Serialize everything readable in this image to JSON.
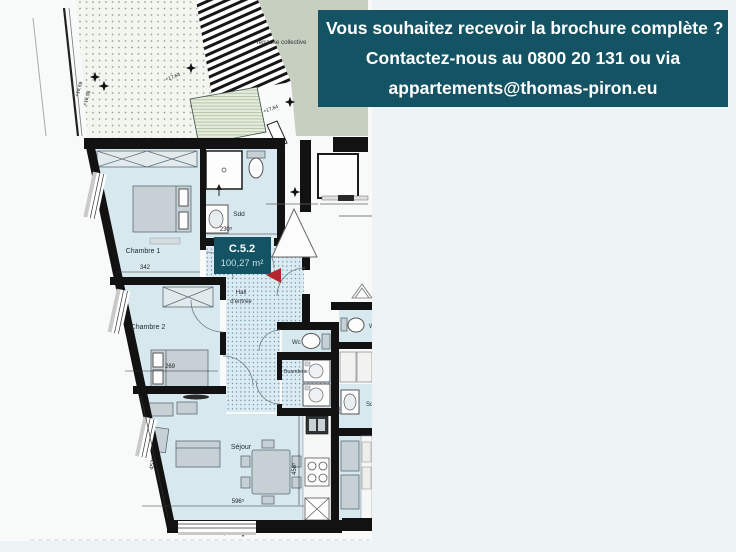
{
  "banner": {
    "line1": "Vous souhaitez recevoir la brochure complète ?",
    "line2": "Contactez-nous au 0800 20 131 ou via",
    "line3": "appartements@thomas-piron.eu",
    "bg_color": "#135363",
    "text_color": "#ffffff"
  },
  "plan": {
    "unit_badge": {
      "code": "C.5.2",
      "area": "100,27 m²"
    },
    "rooms": {
      "terrasse": "Terrasse collective",
      "chambre1": "Chambre 1",
      "chambre2": "Chambre 2",
      "sdd": "Sdd",
      "hall_line1": "Hall",
      "hall_line2": "d'entrée",
      "wc": "Wc",
      "buanderie": "Buanderie",
      "sejour": "Séjour"
    },
    "dimensions": {
      "chambre1_width": "342",
      "sdd_width": "230⁵",
      "chambre2_width": "269",
      "sejour_width": "596⁵",
      "sejour_depth": "458⁵",
      "sejour_left": "452⁵",
      "neighbor_sdb": "240"
    },
    "levels": {
      "l1": "+16,69",
      "l2": "+16,56",
      "l3": "+17,64",
      "l4": "+17,64",
      "l5": "+17,88",
      "l6": "+12,48"
    },
    "neighbor": {
      "wc_partial": "W",
      "sdb_partial": "Sd"
    },
    "colors": {
      "accent": "#135363",
      "arrow_red": "#b5252c",
      "room_fill": "#d7e8ef",
      "terrace_green": "#c7cfc1",
      "wall": "#121212"
    }
  }
}
